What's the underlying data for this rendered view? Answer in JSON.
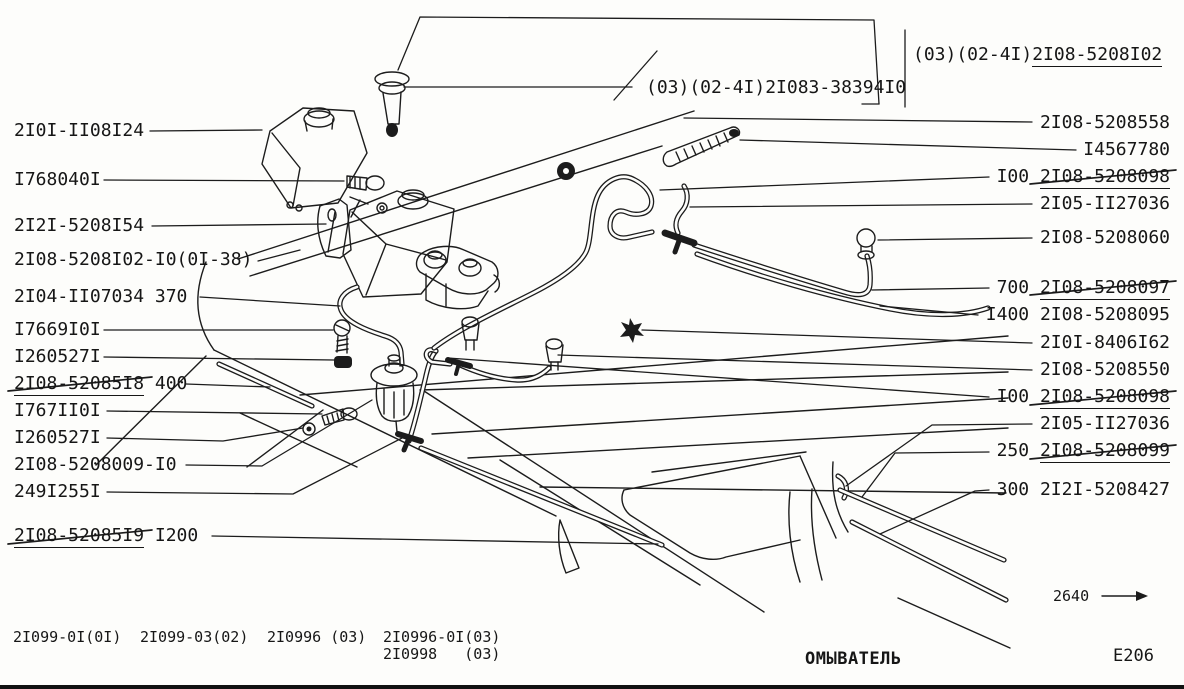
{
  "footer": {
    "caption": "ОМЫВАТЕЛЬ",
    "page_ref": "E206",
    "dimension": "2640"
  },
  "models": [
    {
      "text": "2I099-0I(0I)",
      "x": 13,
      "y": 629
    },
    {
      "text": "2I099-03(02)",
      "x": 140,
      "y": 629
    },
    {
      "text": "2I0996 (03)",
      "x": 267,
      "y": 629
    },
    {
      "text": "2I0996-0I(03)",
      "x": 383,
      "y": 629
    },
    {
      "text": "2I0998   (03)",
      "x": 383,
      "y": 646
    }
  ],
  "callouts": {
    "top": [
      {
        "plain": "(03)(02-4I)",
        "uline": "2I08-5208I02",
        "x": 913,
        "y": 46,
        "align": "left",
        "leaders": [
          [
            [
              905,
              30
            ],
            [
              905,
              107
            ]
          ]
        ]
      },
      {
        "plain": "(03)(02-4I)2I083-38394I0",
        "x": 646,
        "y": 79,
        "align": "left",
        "leaders": [
          [
            [
              404,
              87
            ],
            [
              632,
              87
            ]
          ],
          [
            [
              614,
              100
            ],
            [
              657,
              51
            ]
          ],
          [
            [
              398,
              70
            ],
            [
              420,
              17
            ],
            [
              874,
              20
            ],
            [
              879,
              104
            ]
          ],
          [
            [
              862,
              104
            ],
            [
              879,
              104
            ]
          ]
        ]
      }
    ],
    "left": [
      {
        "plain": "2I0I-II08I24",
        "x": 14,
        "y": 122,
        "align": "left",
        "leaders": [
          [
            [
              150,
              131
            ],
            [
              262,
              130
            ]
          ]
        ]
      },
      {
        "plain": "I768040I",
        "x": 14,
        "y": 171,
        "align": "left",
        "leaders": [
          [
            [
              104,
              180
            ],
            [
              344,
              181
            ]
          ]
        ]
      },
      {
        "plain": "2I2I-5208I54",
        "x": 14,
        "y": 217,
        "align": "left",
        "leaders": [
          [
            [
              152,
              226
            ],
            [
              326,
              224
            ]
          ]
        ]
      },
      {
        "plain": "2I08-5208I02-I0(0I-38)",
        "x": 14,
        "y": 251,
        "align": "left",
        "leaders": [
          [
            [
              258,
              261
            ],
            [
              300,
              250
            ]
          ]
        ]
      },
      {
        "plain": "2I04-II07034 370",
        "x": 14,
        "y": 288,
        "align": "left",
        "leaders": [
          [
            [
              200,
              297
            ],
            [
              340,
              306
            ]
          ]
        ]
      },
      {
        "plain": "I7669I0I",
        "x": 14,
        "y": 321,
        "align": "left",
        "leaders": [
          [
            [
              104,
              330
            ],
            [
              333,
              330
            ]
          ]
        ]
      },
      {
        "plain": "I260527I",
        "x": 14,
        "y": 348,
        "align": "left",
        "leaders": [
          [
            [
              104,
              357
            ],
            [
              334,
              360
            ]
          ]
        ]
      },
      {
        "uline": "2I08-52085I8",
        "tail": " 400",
        "x": 14,
        "y": 375,
        "align": "left",
        "leaders": [
          [
            [
              186,
              384
            ],
            [
              270,
              387
            ]
          ]
        ],
        "strike": [
          [
            8,
            391
          ],
          [
            152,
            377
          ]
        ]
      },
      {
        "plain": "I767II0I",
        "x": 14,
        "y": 402,
        "align": "left",
        "leaders": [
          [
            [
              107,
              411
            ],
            [
              322,
              414
            ]
          ]
        ]
      },
      {
        "plain": "I260527I",
        "x": 14,
        "y": 429,
        "align": "left",
        "leaders": [
          [
            [
              107,
              438
            ],
            [
              223,
              441
            ],
            [
              303,
              428
            ]
          ]
        ]
      },
      {
        "plain": "2I08-5208009-I0",
        "x": 14,
        "y": 456,
        "align": "left",
        "leaders": [
          [
            [
              186,
              465
            ],
            [
              262,
              466
            ],
            [
              372,
              400
            ]
          ]
        ]
      },
      {
        "plain": "249I255I",
        "x": 14,
        "y": 483,
        "align": "left",
        "leaders": [
          [
            [
              107,
              492
            ],
            [
              293,
              494
            ],
            [
              404,
              437
            ]
          ]
        ]
      },
      {
        "uline": "2I08-52085I9",
        "tail": " I200",
        "x": 14,
        "y": 527,
        "align": "left",
        "leaders": [
          [
            [
              212,
              536
            ],
            [
              658,
              544
            ]
          ]
        ],
        "strike": [
          [
            8,
            544
          ],
          [
            152,
            530
          ]
        ]
      }
    ],
    "right": [
      {
        "plain": "2I08-5208558",
        "x": 1170,
        "y": 114,
        "align": "right",
        "leaders": [
          [
            [
              1032,
              122
            ],
            [
              684,
              118
            ]
          ]
        ]
      },
      {
        "plain": "I4567780",
        "x": 1170,
        "y": 141,
        "align": "right",
        "leaders": [
          [
            [
              1076,
              150
            ],
            [
              740,
              140
            ]
          ]
        ]
      },
      {
        "plain": "I00 ",
        "uline": "2I08-5208098",
        "x": 1170,
        "y": 168,
        "align": "right",
        "leaders": [
          [
            [
              989,
              177
            ],
            [
              660,
              190
            ]
          ]
        ],
        "strike": [
          [
            1030,
            184
          ],
          [
            1176,
            170
          ]
        ]
      },
      {
        "plain": "2I05-II27036",
        "x": 1170,
        "y": 195,
        "align": "right",
        "leaders": [
          [
            [
              1032,
              204
            ],
            [
              690,
              207
            ]
          ]
        ]
      },
      {
        "plain": "2I08-5208060",
        "x": 1170,
        "y": 229,
        "align": "right",
        "leaders": [
          [
            [
              1032,
              238
            ],
            [
              878,
              240
            ]
          ]
        ]
      },
      {
        "plain": "700 ",
        "uline": "2I08-5208097",
        "x": 1170,
        "y": 279,
        "align": "right",
        "leaders": [
          [
            [
              989,
              288
            ],
            [
              872,
              290
            ]
          ]
        ],
        "strike": [
          [
            1030,
            295
          ],
          [
            1176,
            281
          ]
        ]
      },
      {
        "plain": "I400 2I08-5208095",
        "x": 1170,
        "y": 306,
        "align": "right",
        "leaders": [
          [
            [
              978,
              315
            ],
            [
              880,
              306
            ]
          ]
        ]
      },
      {
        "plain": "2I0I-8406I62",
        "x": 1170,
        "y": 334,
        "align": "right",
        "leaders": [
          [
            [
              1032,
              343
            ],
            [
              642,
              330
            ]
          ]
        ]
      },
      {
        "plain": "2I08-5208550",
        "x": 1170,
        "y": 361,
        "align": "right",
        "leaders": [
          [
            [
              1032,
              370
            ],
            [
              558,
              355
            ]
          ]
        ]
      },
      {
        "plain": "I00 ",
        "uline": "2I08-5208098",
        "x": 1170,
        "y": 388,
        "align": "right",
        "leaders": [
          [
            [
              989,
              397
            ],
            [
              448,
              358
            ]
          ]
        ],
        "strike": [
          [
            1030,
            405
          ],
          [
            1176,
            391
          ]
        ]
      },
      {
        "plain": "2I05-II27036",
        "x": 1170,
        "y": 415,
        "align": "right",
        "leaders": [
          [
            [
              1032,
              424
            ],
            [
              932,
              425
            ],
            [
              846,
              486
            ]
          ]
        ]
      },
      {
        "plain": "250 ",
        "uline": "2I08-5208099",
        "x": 1170,
        "y": 442,
        "align": "right",
        "leaders": [
          [
            [
              989,
              452
            ],
            [
              895,
              453
            ],
            [
              862,
              497
            ]
          ]
        ],
        "strike": [
          [
            1030,
            459
          ],
          [
            1176,
            445
          ]
        ]
      },
      {
        "plain": "300 2I2I-5208427",
        "x": 1170,
        "y": 481,
        "align": "right",
        "leaders": [
          [
            [
              989,
              490
            ],
            [
              975,
              491
            ],
            [
              880,
              534
            ]
          ]
        ]
      }
    ]
  }
}
